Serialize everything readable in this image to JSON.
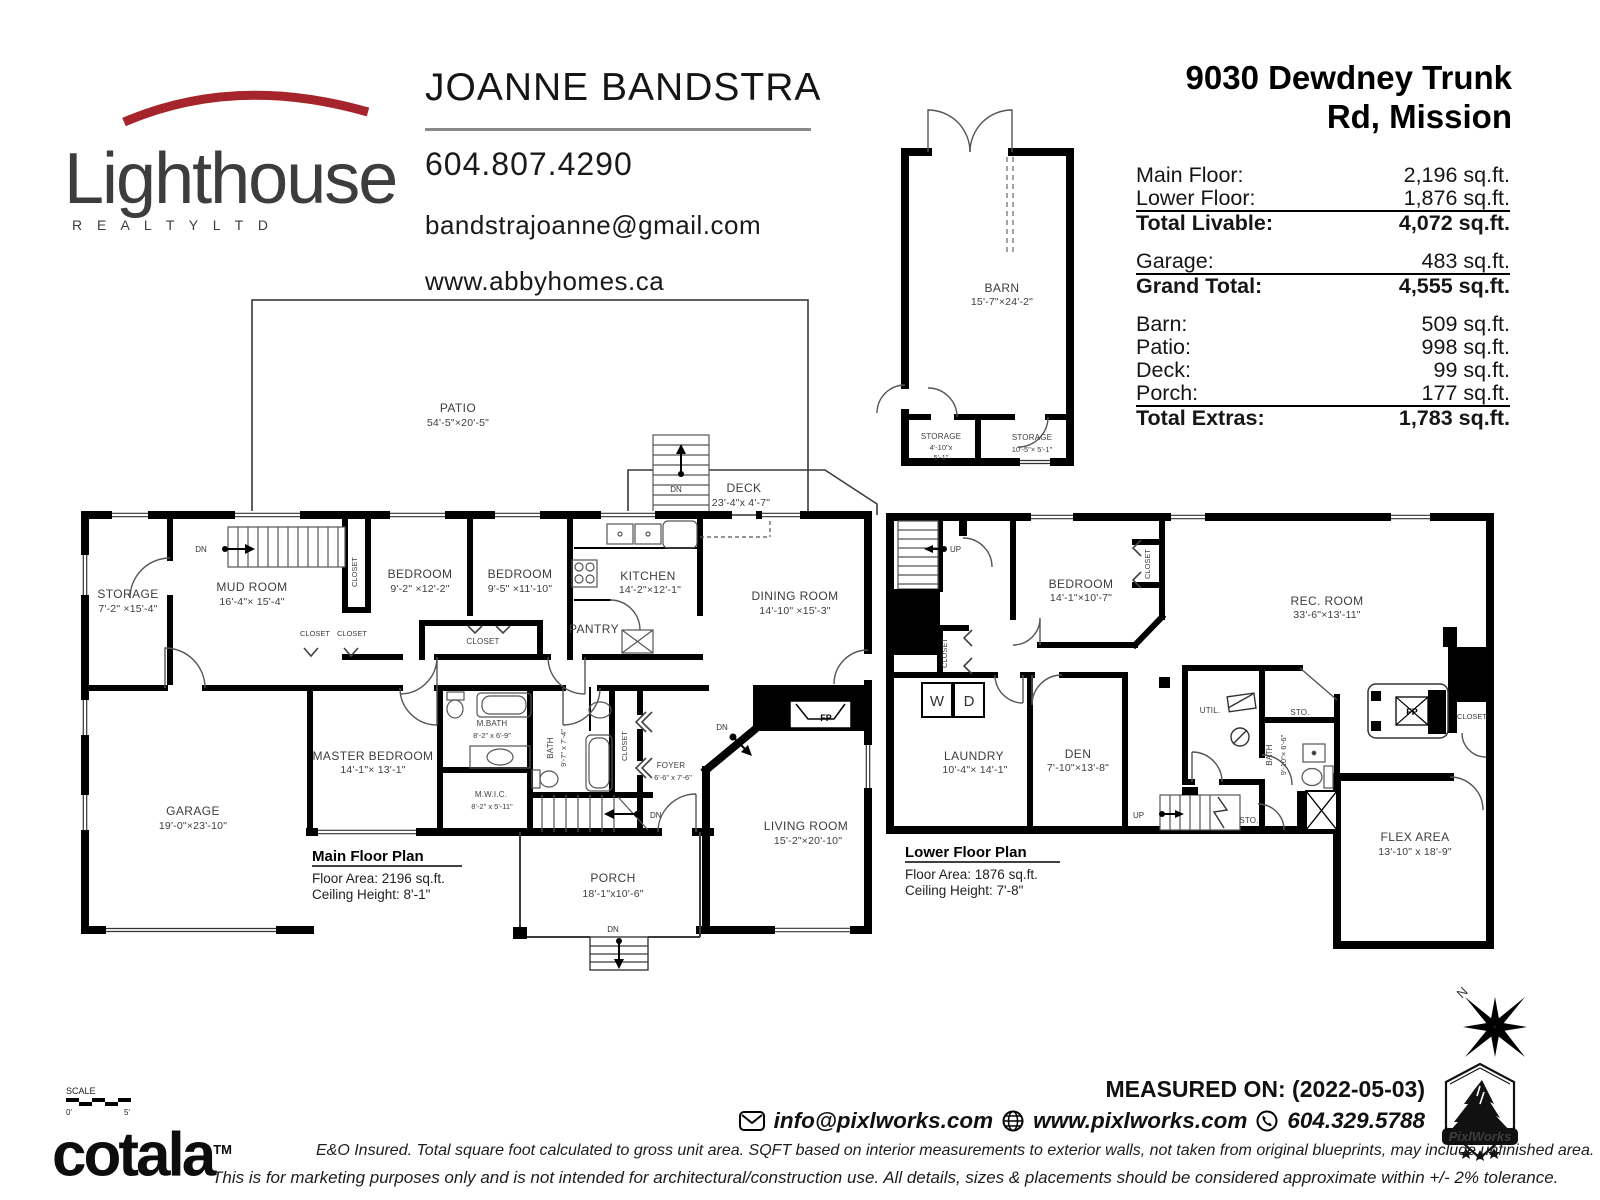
{
  "brand": {
    "logo_text": "Lighthouse",
    "logo_sub": "R E A L T Y    L T D"
  },
  "agent": {
    "name": "JOANNE BANDSTRA",
    "phone": "604.807.4290",
    "email": "bandstrajoanne@gmail.com",
    "website": "www.abbyhomes.ca"
  },
  "property": {
    "address1": "9030 Dewdney Trunk",
    "address2": "Rd, Mission"
  },
  "table": {
    "groups": [
      {
        "rows": [
          {
            "label": "Main Floor:",
            "value": "2,196 sq.ft."
          },
          {
            "label": "Lower Floor:",
            "value": "1,876 sq.ft."
          }
        ],
        "total": {
          "label": "Total Livable:",
          "value": "4,072 sq.ft."
        }
      },
      {
        "rows": [
          {
            "label": "Garage:",
            "value": "483 sq.ft."
          }
        ],
        "total": {
          "label": "Grand Total:",
          "value": "4,555 sq.ft."
        }
      },
      {
        "rows": [
          {
            "label": "Barn:",
            "value": "509 sq.ft."
          },
          {
            "label": "Patio:",
            "value": "998 sq.ft."
          },
          {
            "label": "Deck:",
            "value": "99 sq.ft."
          },
          {
            "label": "Porch:",
            "value": "177 sq.ft."
          }
        ],
        "total": {
          "label": "Total Extras:",
          "value": "1,783 sq.ft."
        }
      }
    ]
  },
  "barn": {
    "name": "BARN",
    "dims": "15'-7\"×24'-2\"",
    "sto1_name": "STORAGE",
    "sto1_d1": "4'-10\"x",
    "sto1_d2": "5'-1\"",
    "sto2_name": "STORAGE",
    "sto2_d": "10'-5\"× 5'-1\""
  },
  "mf": {
    "title": "Main Floor Plan",
    "area": "Floor Area: 2196 sq.ft.",
    "ceiling": "Ceiling Height: 8'-1\"",
    "patio": {
      "n": "PATIO",
      "d": "54'-5\"×20'-5\""
    },
    "deck": {
      "n": "DECK",
      "d": "23'-4\"x 4'-7\""
    },
    "storage": {
      "n": "STORAGE",
      "d": "7'-2\" ×15'-4\""
    },
    "mudroom": {
      "n": "MUD ROOM",
      "d": "16'-4\"× 15'-4\""
    },
    "bedroom1": {
      "n": "BEDROOM",
      "d": "9'-2\" ×12'-2\""
    },
    "bedroom2": {
      "n": "BEDROOM",
      "d": "9'-5\" ×11'-10\""
    },
    "kitchen": {
      "n": "KITCHEN",
      "d": "14'-2\"×12'-1\""
    },
    "pantry": "PANTRY",
    "dining": {
      "n": "DINING ROOM",
      "d": "14'-10\" ×15'-3\""
    },
    "master": {
      "n": "MASTER BEDROOM",
      "d": "14'-1\"× 13'-1\""
    },
    "mbath": {
      "n": "M.BATH",
      "d": "8'-2\" x 6'-9\""
    },
    "mwic": {
      "n": "M.W.I.C.",
      "d": "8'-2\" x 5'-11\""
    },
    "bath": {
      "n": "BATH",
      "d": "9'-7\" x 7'-4\""
    },
    "foyer": {
      "n": "FOYER",
      "d": "6'-6\" x 7'-6\""
    },
    "living": {
      "n": "LIVING ROOM",
      "d": "15'-2\"×20'-10\""
    },
    "garage": {
      "n": "GARAGE",
      "d": "19'-0\"×23'-10\""
    },
    "porch": {
      "n": "PORCH",
      "d": "18'-1\"x10'-6\""
    },
    "closet": "CLOSET",
    "dn": "DN",
    "fp": "FP"
  },
  "lf": {
    "title": "Lower Floor Plan",
    "area": "Floor Area: 1876 sq.ft.",
    "ceiling": "Ceiling Height: 7'-8\"",
    "bedroom": {
      "n": "BEDROOM",
      "d": "14'-1\"×10'-7\""
    },
    "laundry": {
      "n": "LAUNDRY",
      "d": "10'-4\"× 14'-1\""
    },
    "den": {
      "n": "DEN",
      "d": "7'-10\"×13'-8\""
    },
    "rec": {
      "n": "REC. ROOM",
      "d": "33'-6\"×13'-11\""
    },
    "bath": {
      "n": "BATH",
      "d": "9'-10\"× 6'-6\""
    },
    "flex": {
      "n": "FLEX AREA",
      "d": "13'-10\" x 18'-9\""
    },
    "util": "UTIL.",
    "sto": "STO.",
    "w": "W",
    "d": "D",
    "up": "UP",
    "closet": "CLOSET",
    "fp": "FP",
    "dn": "DN"
  },
  "footer": {
    "scale": "SCALE",
    "zero": "0'",
    "five": "5'",
    "cotala": "cotala",
    "tm": "TM",
    "disc1": "E&O Insured.  Total square foot calculated to gross unit area. SQFT based on interior measurements to exterior walls, not taken from original blueprints, may include unfinished area.",
    "disc2": "This is for marketing purposes only and is not intended for architectural/construction use.  All details, sizes & placements should be considered approximate within +/- 2%  tolerance.",
    "measured": "MEASURED ON: (2022-05-03)",
    "email": "info@pixlworks.com",
    "web": "www.pixlworks.com",
    "phone": "604.329.5788",
    "pixlworks": "PixlWorks",
    "north": "N"
  }
}
